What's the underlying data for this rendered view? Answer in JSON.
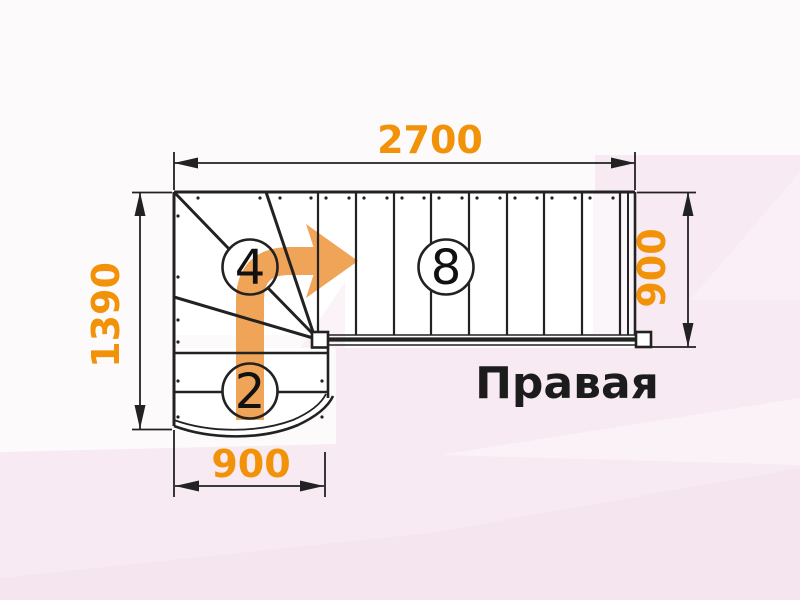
{
  "diagram": {
    "type": "staircase-floor-plan",
    "direction_label": "Правая",
    "dimensions": {
      "top_width": "2700",
      "left_height": "1390",
      "right_height": "900",
      "bottom_width": "900"
    },
    "step_counts": {
      "winder_steps": "4",
      "straight_flight_steps": "8",
      "lower_steps": "2"
    },
    "colors": {
      "dimension_text": "#f29208",
      "walkline_arrow": "#f0a458",
      "linework": "#222222",
      "background_pink": "#f7eaf2",
      "stair_body": "#ffffff"
    }
  }
}
